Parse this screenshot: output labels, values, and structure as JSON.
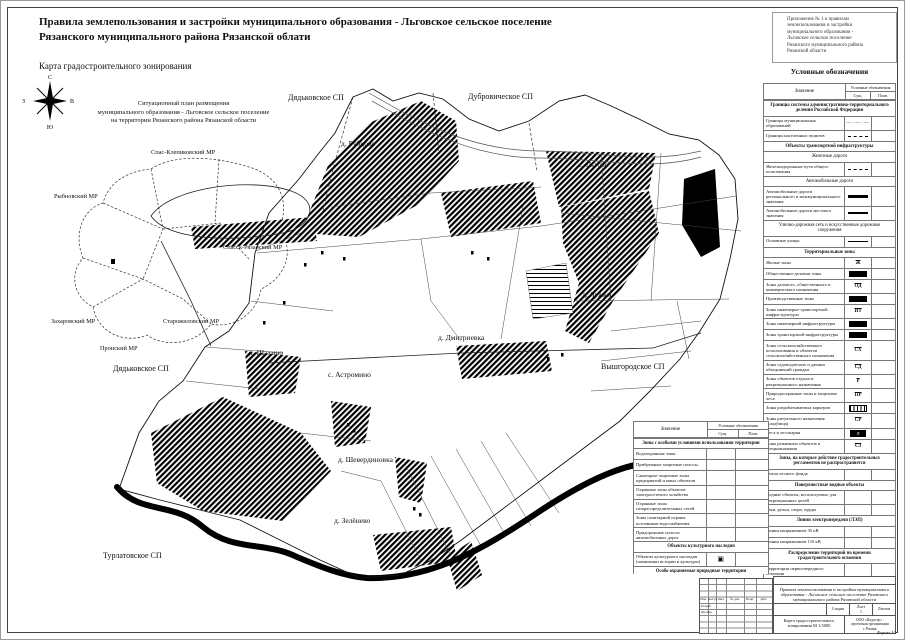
{
  "sheet": {
    "title_line1": "Правила землепользования и застройки муниципального образования - Льговское сельское поселение",
    "title_line2": "Рязанского муниципального района Рязанской облати",
    "subtitle": "Карта градостроительного зонирования",
    "note_lines": [
      "Приложение № 1 к правилам",
      "землепользования и застройки",
      "муниципального образования -",
      "Льговское сельское поселение",
      "Рязанского муниципального района",
      "Рязанской области"
    ],
    "format_label": "Формат А3"
  },
  "compass": {
    "n": "С",
    "s": "Ю",
    "e": "В",
    "w": "З"
  },
  "inset": {
    "title_lines": [
      "Ситуационный план размещения",
      "муниципального образования - Льговское сельское поселение",
      "на территории Рязанского района Рязанской области"
    ],
    "labels": {
      "spas_klepikovsky": "Спас-Клепиковский МР",
      "rybnovsky": "Рыбновский МР",
      "spassk_ryazansky": "Спасск-Рязанский МР",
      "zakharovsky": "Захаровский МР",
      "starozhilovsky": "Старожиловский МР",
      "pronsky": "Пронский МР"
    }
  },
  "map": {
    "neighbors": {
      "dyadkovskoe_top": "Дядьковское СП",
      "dubrovicheskoe": "Дубровическое СП",
      "vyshgorodskoe": "Вышгородское СП",
      "dyadkovskoe_left": "Дядьковское СП",
      "turlatovskoe": "Турлатовское СП"
    },
    "settlements": {
      "rubtsovo": "д. Рубцово",
      "lgovo": "с. Льгово",
      "luzhki": "д. Лужки",
      "dmitrievka": "д. Дмитриевка",
      "shakhino": "д. Шахино",
      "astromino": "с. Астромино",
      "sheverdinovka": "д. Шевердиновка",
      "zelenevo": "д. Зелёнево"
    }
  },
  "legend": {
    "title": "Условные обозначения",
    "col_value": "Значение",
    "col_symbols": "Условные обозначения",
    "col_exist": "Сущ.",
    "col_plan": "План.",
    "rows": [
      {
        "t": "sec",
        "l": "Границы системы административно-территориального деления Российской Федерации"
      },
      {
        "t": "row",
        "l": "Границы муниципальных образований",
        "s": "dashdot",
        "c": "—·—·—"
      },
      {
        "t": "row",
        "l": "Границы населенных пунктов",
        "s": "dash"
      },
      {
        "t": "sec",
        "l": "Объекты транспортной инфраструктуры"
      },
      {
        "t": "sub",
        "l": "Железные дороги"
      },
      {
        "t": "row",
        "l": "Железнодорожные пути общего пользования",
        "s": "dash"
      },
      {
        "t": "sub",
        "l": "Автомобильные дороги"
      },
      {
        "t": "row",
        "l": "Автомобильные дороги регионального и межмуниципального значения",
        "s": "line3"
      },
      {
        "t": "row",
        "l": "Автомобильные дороги местного значения",
        "s": "line2"
      },
      {
        "t": "sub",
        "l": "Улично-дорожная сеть и искусственные дорожные сооружения"
      },
      {
        "t": "row",
        "l": "Основные улицы",
        "s": "line1"
      },
      {
        "t": "sec",
        "l": "Территориальные зоны"
      },
      {
        "t": "row",
        "l": "Жилые зоны",
        "s": "code",
        "c": "Ж"
      },
      {
        "t": "row",
        "l": "Общественно-деловые зоны",
        "s": "black"
      },
      {
        "t": "row",
        "l": "Зоны делового, общественного и коммерческого назначения",
        "s": "code",
        "c": "ОД"
      },
      {
        "t": "row",
        "l": "Производственные зоны",
        "s": "black"
      },
      {
        "t": "row",
        "l": "Зоны инженерно-транспортной инфраструктуры",
        "s": "code",
        "c": "ИТ"
      },
      {
        "t": "row",
        "l": "Зоны инженерной инфраструктуры",
        "s": "black"
      },
      {
        "t": "row",
        "l": "Зоны транспортной инфраструктуры",
        "s": "black"
      },
      {
        "t": "row",
        "l": "Зоны сельскохозяйственного использования и объектов сельскохозяйственного назначения",
        "s": "code",
        "c": "СХ"
      },
      {
        "t": "row",
        "l": "Зоны садоводческих и дачных объединений граждан",
        "s": "code",
        "c": "СД"
      },
      {
        "t": "row",
        "l": "Зоны объектов отдыха и рекреационного назначения",
        "s": "code",
        "c": "Р"
      },
      {
        "t": "row",
        "l": "Природоохранные зоны и защитные леса",
        "s": "code",
        "c": "ПР"
      },
      {
        "t": "row",
        "l": "Зоны разрабатываемых карьеров",
        "s": "hatch"
      },
      {
        "t": "row",
        "l": "Зоны ритуального назначения (кладбища)",
        "s": "code",
        "c": "СР"
      },
      {
        "t": "row",
        "l": "Леса и лесопарки",
        "s": "forest",
        "c": "Л"
      },
      {
        "t": "row",
        "l": "Зоны режимных объектов и спецназначения",
        "s": "code",
        "c": "СЗ"
      },
      {
        "t": "sec",
        "l": "Зоны, на которые действие градостроительных регламентов не распространяется"
      },
      {
        "t": "row",
        "l": "Земли лесного фонда",
        "s": "none"
      },
      {
        "t": "sec",
        "l": "Поверхностные водные объекты"
      },
      {
        "t": "row",
        "l": "Водные объекты, используемые для рекреационных целей",
        "s": "none"
      },
      {
        "t": "row",
        "l": "Реки, ручьи, озера, пруды",
        "s": "none"
      },
      {
        "t": "sec",
        "l": "Линии электропередачи (ЛЭП)"
      },
      {
        "t": "row",
        "l": "Линии напряжением 35 кВ",
        "s": "none"
      },
      {
        "t": "row",
        "l": "Линии напряжением 110 кВ",
        "s": "none"
      },
      {
        "t": "sec",
        "l": "Распределение территорий по времени градостроительного освоения"
      },
      {
        "t": "row",
        "l": "Территории первоочередного освоения",
        "s": "none"
      },
      {
        "t": "sec",
        "l": "Сети газоснабжения"
      },
      {
        "t": "row",
        "l": "Газопроводы",
        "s": "dot",
        "c": "······"
      },
      {
        "t": "sec",
        "l": "Санитарно-защитные зоны"
      },
      {
        "t": "row",
        "l": "Санитарно-защитные зоны предприятий, сооружений и иных объектов",
        "s": "none"
      }
    ]
  },
  "legend2": {
    "col_value": "Значение",
    "col_symbols": "Условные обозначения",
    "col_exist": "Сущ.",
    "col_plan": "План.",
    "rows": [
      {
        "t": "sec",
        "l": "Зоны с особыми условиями использования территории"
      },
      {
        "t": "row",
        "l": "Водоохранные зоны",
        "s": "none"
      },
      {
        "t": "row",
        "l": "Прибрежные защитные полосы",
        "s": "none"
      },
      {
        "t": "row",
        "l": "Санитарно-защитные зоны предприятий и иных объектов",
        "s": "none"
      },
      {
        "t": "row",
        "l": "Охранные зоны объектов электросетевого хозяйства",
        "s": "none"
      },
      {
        "t": "row",
        "l": "Охранные зоны газораспределительных сетей",
        "s": "none"
      },
      {
        "t": "row",
        "l": "Зоны санитарной охраны источников водоснабжения",
        "s": "none"
      },
      {
        "t": "row",
        "l": "Придорожные полосы автомобильных дорог",
        "s": "none"
      },
      {
        "t": "sec",
        "l": "Объекты культурного наследия"
      },
      {
        "t": "row",
        "l": "Объекты культурного наследия (памятники истории и культуры)",
        "s": "okn",
        "c": "▣"
      },
      {
        "t": "sec",
        "l": "Особо охраняемые природные территории"
      },
      {
        "t": "row",
        "l": "Природный парк",
        "s": "none"
      }
    ]
  },
  "stamp": {
    "doc_title": "Правила землепользования и застройки муниципального образования - Льговское сельское поселение Рязанского муниципального района Рязанской области",
    "map_title": "Карта градостроительного зонирования М 1:5000",
    "org_lines": [
      "ООО «Кадастр» -",
      "проектная организация",
      "г. Рязань"
    ],
    "stage_label": "Стадия",
    "sheet_label": "Лист",
    "sheets_label": "Листов",
    "sheet_value": "1",
    "rev_cols": [
      "Изм.",
      "Кол.уч.",
      "Лист",
      "№ док.",
      "Подп.",
      "Дата"
    ],
    "row_dev": "Разраб.",
    "row_check": "Провер."
  }
}
